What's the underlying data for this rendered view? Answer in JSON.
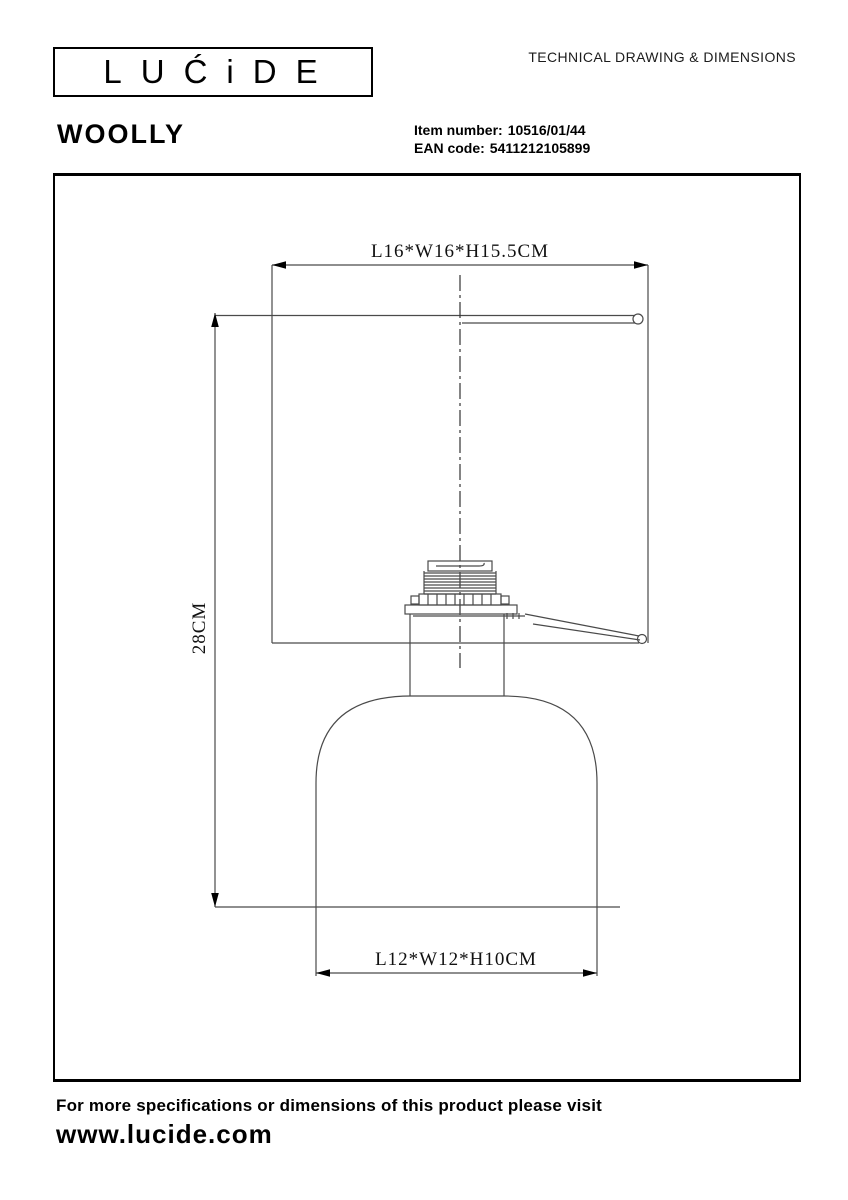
{
  "header": {
    "logo_text": "LUĆiDE",
    "title": "TECHNICAL DRAWING & DIMENSIONS"
  },
  "product": {
    "name": "WOOLLY",
    "item_number_label": "Item number:",
    "item_number": "10516/01/44",
    "ean_label": "EAN code:",
    "ean": "5411212105899"
  },
  "drawing": {
    "dim_shade": "L16*W16*H15.5CM",
    "dim_height": "28CM",
    "dim_base": "L12*W12*H10CM"
  },
  "footer": {
    "line1": "For more specifications or dimensions of this product please visit",
    "website": "www.lucide.com"
  }
}
